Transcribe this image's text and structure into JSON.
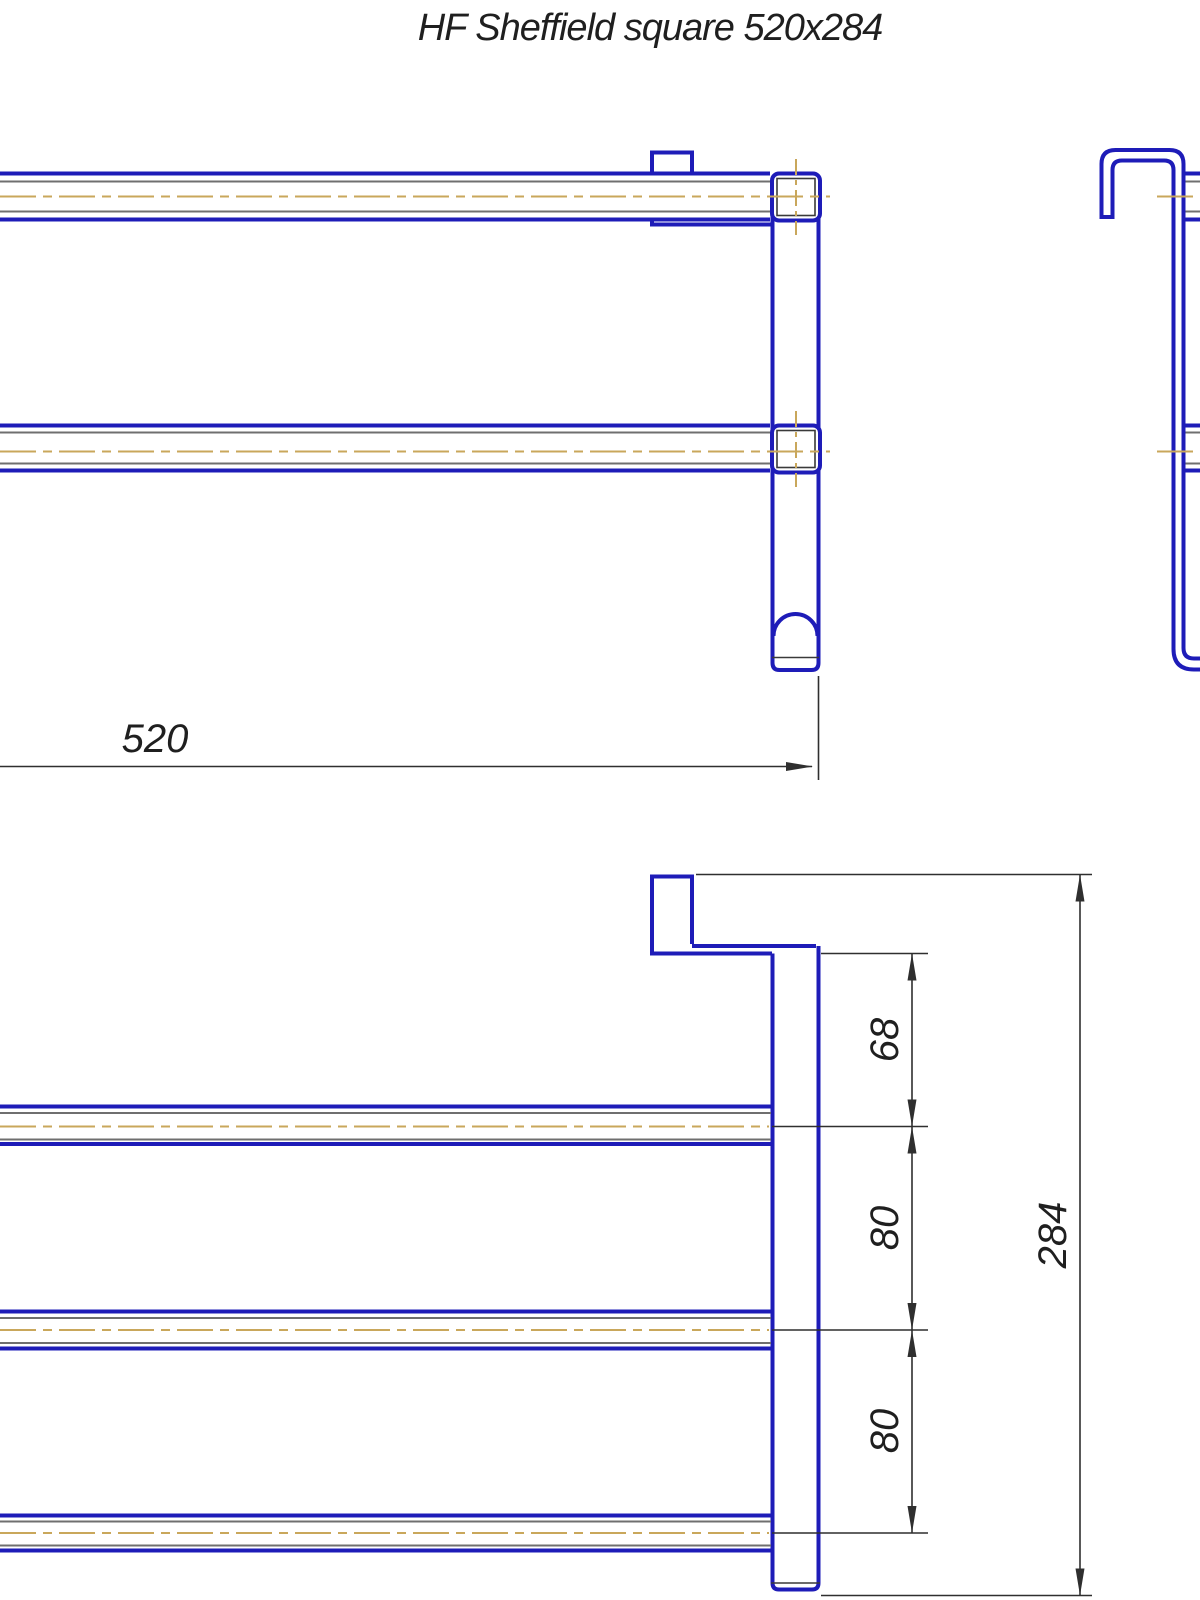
{
  "title": "HF Sheffield square 520x284",
  "colors": {
    "outline_blue": "#1e1cb8",
    "inner_gray": "#6f6f6f",
    "centerline_tan": "#c9a75b",
    "dim_black": "#2f2f2f",
    "text_color": "#1f1f1f",
    "background": "#ffffff"
  },
  "dimensions": {
    "overall_width": "520",
    "hook_to_first_rail": "68",
    "rail_spacing_1": "80",
    "rail_spacing_2": "80",
    "overall_height": "284"
  }
}
